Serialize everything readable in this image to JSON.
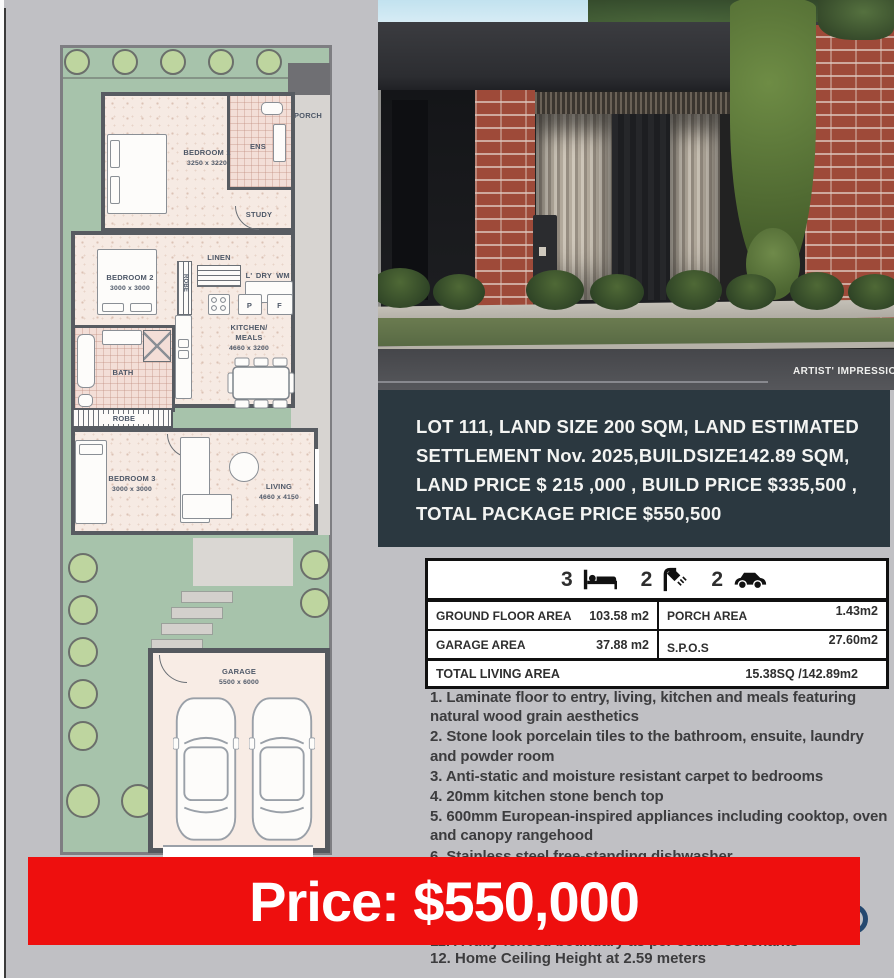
{
  "floorplan": {
    "porch": "PORCH",
    "bedroom1": {
      "name": "BEDROOM 1",
      "dims": "3250 x 3220"
    },
    "ens": "ENS",
    "study": "STUDY",
    "robe": "ROBE",
    "bedroom2": {
      "name": "BEDROOM 2",
      "dims": "3000 x 3000"
    },
    "linen": "LINEN",
    "laundry": "L'",
    "dry": "DRY",
    "wm": "WM",
    "pantry": "P",
    "fridge": "F",
    "kitchen": {
      "line1": "KITCHEN/",
      "line2": "MEALS",
      "dims": "4660 x 3200"
    },
    "bath": "BATH",
    "bedroom3": {
      "name": "BEDROOM 3",
      "dims": "3000 x 3000"
    },
    "living": {
      "name": "LIVING",
      "dims": "4660 x 4150"
    },
    "garage": {
      "name": "GARAGE",
      "dims": "5500 x 6000"
    }
  },
  "photo": {
    "caption": "ARTIST' IMPRESSION O"
  },
  "info_box": {
    "line1": "LOT 111,  LAND SIZE 200 SQM, LAND ESTIMATED",
    "line2": "SETTLEMENT Nov. 2025,BUILDSIZE142.89 SQM,",
    "line3": "LAND PRICE $ 215 ,000 , BUILD PRICE $335,500 ,",
    "line4": "TOTAL PACKAGE PRICE $550,500",
    "bg": "#2b3840"
  },
  "summary_table": {
    "beds": "3",
    "baths": "2",
    "cars": "2",
    "rows": [
      {
        "label": "GROUND FLOOR AREA",
        "value": "103.58 m2",
        "label2": "PORCH AREA",
        "value2": "1.43m2"
      },
      {
        "label": "GARAGE AREA",
        "value": "37.88 m2",
        "label2": "S.P.O.S",
        "value2": "27.60m2"
      }
    ],
    "total_label": "TOTAL LIVING AREA",
    "total_value": "15.38SQ /142.89m2"
  },
  "features": {
    "item1": "1.  Laminate floor to entry, living, kitchen and meals featuring natural wood grain aesthetics",
    "item2": "2.  Stone look porcelain tiles to the bathroom, ensuite, laundry and powder room",
    "item3": "3.  Anti-static and moisture resistant carpet to bedrooms",
    "item4": "4.  20mm kitchen stone bench top",
    "item5": "5.  600mm European-inspired appliances including cooktop, oven and canopy rangehood",
    "item6": "6.  Stainless steel free-standing dishwasher",
    "item11": "11. A fully fenced boundary as per estate covenants",
    "item12": "12. Home Ceiling Height at 2.59 meters"
  },
  "price_banner": {
    "text": "Price: $550,000",
    "bg": "#ee0f0e"
  }
}
